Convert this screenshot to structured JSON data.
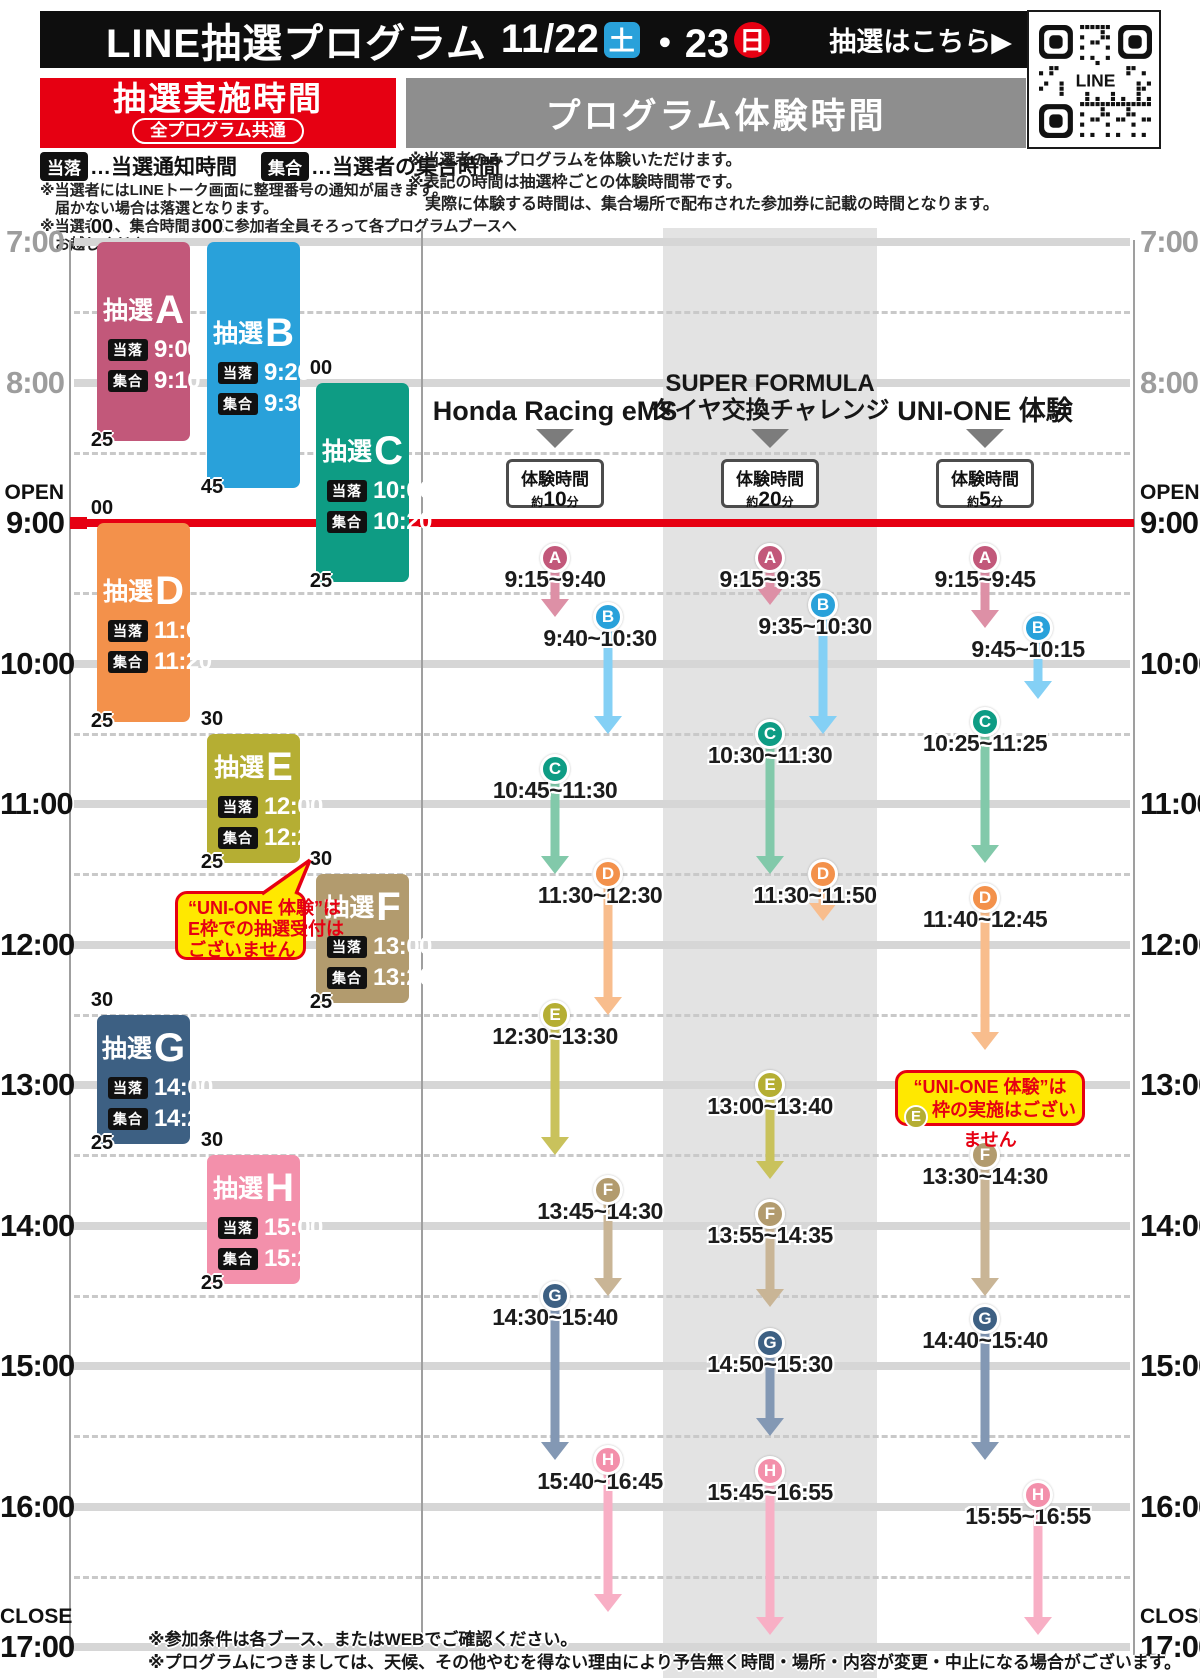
{
  "header": {
    "title": "LINE抽選プログラム",
    "date": "11/22",
    "day1": "土",
    "date2": "・23",
    "day2": "日",
    "cta": "抽選はこちら▶",
    "qr_label": "LINE"
  },
  "lottery_header": {
    "title": "抽選実施時間",
    "subtitle": "全プログラム共通"
  },
  "program_header": {
    "title": "プログラム体験時間"
  },
  "legend": {
    "win_badge": "当落",
    "win_text": "…当選通知時間",
    "meet_badge": "集合",
    "meet_text": "…当選者の集合時間",
    "notes": [
      "※当選者にはLINEトーク画面に整理番号の通知が届きます。",
      "届かない場合は落選となります。",
      "※当選者は、集合時間までに参加者全員そろって各プログラムブースへ",
      "お越しください。"
    ]
  },
  "program_notes": [
    "※当選者のみプログラムを体験いただけます。",
    "※表記の時間は抽選枠ごとの体験時間帯です。",
    "実際に体験する時間は、集合場所で配布された参加券に記載の時間となります。"
  ],
  "axis": {
    "open_label": "OPEN",
    "close_label": "CLOSE",
    "open_time": "9:00",
    "close_time": "17:00",
    "hours": [
      "7:00",
      "8:00",
      "9:00",
      "10:00",
      "11:00",
      "12:00",
      "13:00",
      "14:00",
      "15:00",
      "16:00",
      "17:00"
    ],
    "muted_hours": [
      "7:00",
      "8:00"
    ]
  },
  "letters": {
    "A": {
      "color": "#c2587a",
      "arrow": "#dd90a6"
    },
    "B": {
      "color": "#29a1da",
      "arrow": "#84d0f5"
    },
    "C": {
      "color": "#0e9c84",
      "arrow": "#82c9aa"
    },
    "D": {
      "color": "#f3914b",
      "arrow": "#f8bd8d"
    },
    "E": {
      "color": "#b5ae33",
      "arrow": "#c9c25c"
    },
    "F": {
      "color": "#b29b6e",
      "arrow": "#c9b596"
    },
    "G": {
      "color": "#3d6083",
      "arrow": "#8398b4"
    },
    "H": {
      "color": "#f390ab",
      "arrow": "#f8afc5"
    }
  },
  "blocks": [
    {
      "letter": "A",
      "prefix": "抽選",
      "start": "7:00",
      "end": "8:25",
      "start_label": "00",
      "end_label": "25",
      "win_label": "当落",
      "win": "9:00",
      "meet_label": "集合",
      "meet": "9:10",
      "col": 0
    },
    {
      "letter": "B",
      "prefix": "抽選",
      "start": "7:00",
      "end": "8:45",
      "start_label": "00",
      "end_label": "45",
      "win_label": "当落",
      "win": "9:20",
      "meet_label": "集合",
      "meet": "9:30",
      "col": 1
    },
    {
      "letter": "C",
      "prefix": "抽選",
      "start": "8:00",
      "end": "9:25",
      "start_label": "00",
      "end_label": "25",
      "win_label": "当落",
      "win": "10:00",
      "meet_label": "集合",
      "meet": "10:20",
      "col": 2
    },
    {
      "letter": "D",
      "prefix": "抽選",
      "start": "9:00",
      "end": "10:25",
      "start_label": "00",
      "end_label": "25",
      "win_label": "当落",
      "win": "11:00",
      "meet_label": "集合",
      "meet": "11:20",
      "col": 0
    },
    {
      "letter": "E",
      "prefix": "抽選",
      "start": "10:30",
      "end": "11:25",
      "start_label": "30",
      "end_label": "25",
      "win_label": "当落",
      "win": "12:00",
      "meet_label": "集合",
      "meet": "12:20",
      "col": 1
    },
    {
      "letter": "F",
      "prefix": "抽選",
      "start": "11:30",
      "end": "12:25",
      "start_label": "30",
      "end_label": "25",
      "win_label": "当落",
      "win": "13:00",
      "meet_label": "集合",
      "meet": "13:20",
      "col": 2
    },
    {
      "letter": "G",
      "prefix": "抽選",
      "start": "12:30",
      "end": "13:25",
      "start_label": "30",
      "end_label": "25",
      "win_label": "当落",
      "win": "14:00",
      "meet_label": "集合",
      "meet": "14:20",
      "col": 0
    },
    {
      "letter": "H",
      "prefix": "抽選",
      "start": "13:30",
      "end": "14:25",
      "start_label": "30",
      "end_label": "25",
      "win_label": "当落",
      "win": "15:00",
      "meet_label": "集合",
      "meet": "15:20",
      "col": 1
    }
  ],
  "bubble_note": {
    "lines": [
      "“UNI-ONE 体験”は",
      "E枠での抽選受付は",
      "ございません"
    ]
  },
  "columns": [
    {
      "title_lines": [
        "Honda Racing eMS"
      ],
      "duration_label": "体験時間",
      "duration_prefix": "約",
      "duration_value": "10",
      "duration_unit": "分",
      "shaded": false,
      "slots": [
        {
          "letter": "A",
          "start": "9:15",
          "end": "9:40",
          "range": "9:15~9:40",
          "offset": false
        },
        {
          "letter": "B",
          "start": "9:40",
          "end": "10:30",
          "range": "9:40~10:30",
          "offset": true
        },
        {
          "letter": "C",
          "start": "10:45",
          "end": "11:30",
          "range": "10:45~11:30",
          "offset": false
        },
        {
          "letter": "D",
          "start": "11:30",
          "end": "12:30",
          "range": "11:30~12:30",
          "offset": true
        },
        {
          "letter": "E",
          "start": "12:30",
          "end": "13:30",
          "range": "12:30~13:30",
          "offset": false
        },
        {
          "letter": "F",
          "start": "13:45",
          "end": "14:30",
          "range": "13:45~14:30",
          "offset": true
        },
        {
          "letter": "G",
          "start": "14:30",
          "end": "15:40",
          "range": "14:30~15:40",
          "offset": false
        },
        {
          "letter": "H",
          "start": "15:40",
          "end": "16:45",
          "range": "15:40~16:45",
          "offset": true
        }
      ]
    },
    {
      "title_lines": [
        "SUPER FORMULA",
        "タイヤ交換チャレンジ"
      ],
      "duration_label": "体験時間",
      "duration_prefix": "約",
      "duration_value": "20",
      "duration_unit": "分",
      "shaded": true,
      "slots": [
        {
          "letter": "A",
          "start": "9:15",
          "end": "9:35",
          "range": "9:15~9:35",
          "offset": false
        },
        {
          "letter": "B",
          "start": "9:35",
          "end": "10:30",
          "range": "9:35~10:30",
          "offset": true
        },
        {
          "letter": "C",
          "start": "10:30",
          "end": "11:30",
          "range": "10:30~11:30",
          "offset": false
        },
        {
          "letter": "D",
          "start": "11:30",
          "end": "11:50",
          "range": "11:30~11:50",
          "offset": true
        },
        {
          "letter": "E",
          "start": "13:00",
          "end": "13:40",
          "range": "13:00~13:40",
          "offset": false
        },
        {
          "letter": "F",
          "start": "13:55",
          "end": "14:35",
          "range": "13:55~14:35",
          "offset": false
        },
        {
          "letter": "G",
          "start": "14:50",
          "end": "15:30",
          "range": "14:50~15:30",
          "offset": false
        },
        {
          "letter": "H",
          "start": "15:45",
          "end": "16:55",
          "range": "15:45~16:55",
          "offset": false
        }
      ]
    },
    {
      "title_lines": [
        "UNI-ONE 体験"
      ],
      "duration_label": "体験時間",
      "duration_prefix": "約",
      "duration_value": "5",
      "duration_unit": "分",
      "shaded": false,
      "no_slot_note": {
        "line1": "“UNI-ONE 体験”は",
        "circle_letter": "E",
        "line2": "枠の実施はございません"
      },
      "slots": [
        {
          "letter": "A",
          "start": "9:15",
          "end": "9:45",
          "range": "9:15~9:45",
          "offset": false
        },
        {
          "letter": "B",
          "start": "9:45",
          "end": "10:15",
          "range": "9:45~10:15",
          "offset": true
        },
        {
          "letter": "C",
          "start": "10:25",
          "end": "11:25",
          "range": "10:25~11:25",
          "offset": false
        },
        {
          "letter": "D",
          "start": "11:40",
          "end": "12:45",
          "range": "11:40~12:45",
          "offset": false
        },
        {
          "letter": "F",
          "start": "13:30",
          "end": "14:30",
          "range": "13:30~14:30",
          "offset": false
        },
        {
          "letter": "G",
          "start": "14:40",
          "end": "15:40",
          "range": "14:40~15:40",
          "offset": false
        },
        {
          "letter": "H",
          "start": "15:55",
          "end": "16:55",
          "range": "15:55~16:55",
          "offset": true
        }
      ]
    }
  ],
  "footer_notes": [
    "※参加条件は各ブース、またはWEBでご確認ください。",
    "※プログラムにつきましては、天候、その他やむを得ない理由により予告無く時間・場所・内容が変更・中止になる場合がございます。"
  ],
  "colors": {
    "accent_red": "#e60012",
    "header_gray": "#8e8e8e",
    "band_gray": "#e3e3e3",
    "note_yellow": "#ffe800"
  }
}
